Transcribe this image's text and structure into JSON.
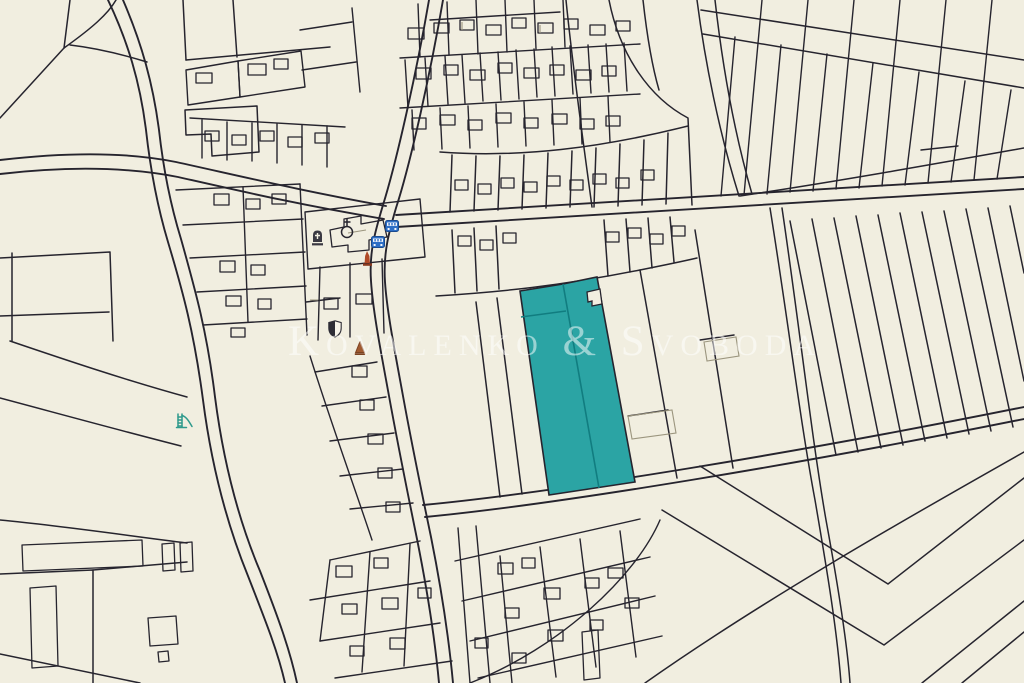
{
  "map": {
    "type": "cadastral-parcel-map",
    "background_color": "#f1eee0",
    "parcel_line_color": "#26242e",
    "watermark": {
      "text": "Kovalenko & Svoboda",
      "color": "rgba(255,255,255,0.52)"
    },
    "highlight": {
      "description": "selected land parcels (long strip plots)",
      "fill_color": "#2ba4a4",
      "inner_line_color": "#117d80",
      "sub_parcel_count": 3
    },
    "icons": [
      {
        "name": "tombstone-icon",
        "color": "#3a3942"
      },
      {
        "name": "church-symbol-icon",
        "color": "#26242e"
      },
      {
        "name": "bus-stop-icon",
        "color": "#2d6ec5",
        "count": 2
      },
      {
        "name": "memorial-red-icon",
        "color": "#b04a28"
      },
      {
        "name": "heraldic-shield-icon",
        "colors": [
          "#2e2d36",
          "#f7f4ea"
        ]
      },
      {
        "name": "obelisk-brown-icon",
        "color": "#a05a30"
      },
      {
        "name": "playground-slide-icon",
        "color": "#2f9a8c"
      },
      {
        "name": "red-marker",
        "color": "#cf2b20"
      }
    ]
  }
}
